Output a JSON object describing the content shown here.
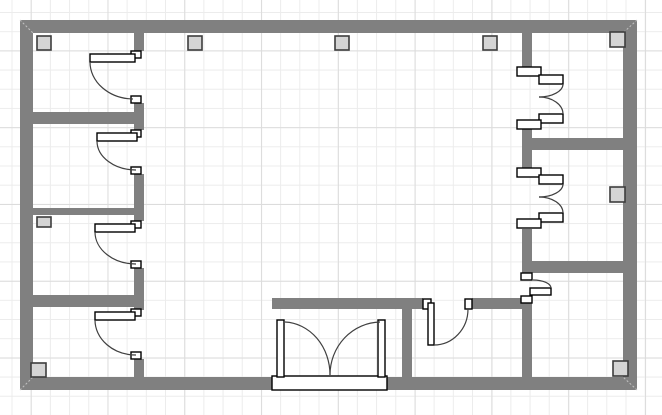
{
  "floorplan": {
    "canvas": {
      "width": 662,
      "height": 415,
      "bg": "#ffffff",
      "grid": {
        "minor": {
          "size": 19.2,
          "color": "#ececec",
          "offset_x": 11.5,
          "offset_y": 12
        },
        "major": {
          "size": 76.8,
          "color": "#dcdcdc",
          "offset_x": 30.7,
          "offset_y": 50.4
        }
      }
    },
    "style": {
      "wall_color": "#808080",
      "column_fill": "#d4d4d4",
      "column_stroke": "#3d3d3d",
      "column_stroke_width": 1.6,
      "door_fill": "#ffffff",
      "door_stroke": "#000000",
      "door_stroke_width": 1.4,
      "arc_color": "#404040",
      "arc_width": 1.2,
      "miter_color": "#c2c2c2"
    },
    "walls": [
      {
        "id": "outer-top",
        "x": 20,
        "y": 20,
        "w": 617,
        "h": 13
      },
      {
        "id": "outer-left",
        "x": 20,
        "y": 20,
        "w": 13,
        "h": 370
      },
      {
        "id": "outer-right",
        "x": 623,
        "y": 20,
        "w": 14,
        "h": 370
      },
      {
        "id": "outer-bottom-left",
        "x": 20,
        "y": 377,
        "w": 252,
        "h": 13
      },
      {
        "id": "outer-bottom-right",
        "x": 387,
        "y": 377,
        "w": 250,
        "h": 13
      },
      {
        "id": "left-core-a",
        "x": 134,
        "y": 33,
        "w": 10,
        "h": 18
      },
      {
        "id": "left-core-b",
        "x": 134,
        "y": 103,
        "w": 10,
        "h": 27
      },
      {
        "id": "left-core-c",
        "x": 134,
        "y": 174,
        "w": 10,
        "h": 47
      },
      {
        "id": "left-core-d",
        "x": 134,
        "y": 268,
        "w": 10,
        "h": 42
      },
      {
        "id": "left-core-e",
        "x": 134,
        "y": 359,
        "w": 10,
        "h": 18
      },
      {
        "id": "left-divider-1",
        "x": 33,
        "y": 112,
        "w": 111,
        "h": 12
      },
      {
        "id": "left-divider-2-thin",
        "x": 33,
        "y": 208,
        "w": 111,
        "h": 7
      },
      {
        "id": "left-divider-3",
        "x": 33,
        "y": 295,
        "w": 111,
        "h": 12
      },
      {
        "id": "right-core-a",
        "x": 522,
        "y": 33,
        "w": 10,
        "h": 34
      },
      {
        "id": "right-core-b",
        "x": 522,
        "y": 129,
        "w": 10,
        "h": 39
      },
      {
        "id": "right-core-c",
        "x": 522,
        "y": 229,
        "w": 10,
        "h": 44
      },
      {
        "id": "right-core-d",
        "x": 522,
        "y": 303,
        "w": 10,
        "h": 74
      },
      {
        "id": "right-divider-1",
        "x": 532,
        "y": 138,
        "w": 91,
        "h": 12
      },
      {
        "id": "right-divider-2",
        "x": 532,
        "y": 261,
        "w": 91,
        "h": 12
      },
      {
        "id": "bottom-partition-h1",
        "x": 272,
        "y": 298,
        "w": 151,
        "h": 11
      },
      {
        "id": "bottom-partition-h2",
        "x": 472,
        "y": 298,
        "w": 50,
        "h": 11
      },
      {
        "id": "bottom-partition-v",
        "x": 402,
        "y": 309,
        "w": 10,
        "h": 68
      }
    ],
    "columns": [
      {
        "x": 37,
        "y": 36,
        "w": 14,
        "h": 14
      },
      {
        "x": 188,
        "y": 36,
        "w": 14,
        "h": 14
      },
      {
        "x": 335,
        "y": 36,
        "w": 14,
        "h": 14
      },
      {
        "x": 483,
        "y": 36,
        "w": 14,
        "h": 14
      },
      {
        "x": 610,
        "y": 32,
        "w": 15,
        "h": 15
      },
      {
        "x": 37,
        "y": 217,
        "w": 14,
        "h": 10
      },
      {
        "x": 31,
        "y": 363,
        "w": 15,
        "h": 14
      },
      {
        "x": 610,
        "y": 187,
        "w": 15,
        "h": 15
      },
      {
        "x": 613,
        "y": 361,
        "w": 15,
        "h": 15
      }
    ],
    "doors": [
      {
        "id": "door-room-1",
        "rects": [
          [
            131,
            51,
            10,
            7
          ],
          [
            131,
            96,
            10,
            7
          ],
          [
            90,
            54,
            45,
            8
          ]
        ],
        "arcs": [
          "M 90 62 A 44 37 0 0 0 133 99"
        ]
      },
      {
        "id": "door-room-2",
        "rects": [
          [
            131,
            130,
            10,
            7
          ],
          [
            131,
            167,
            10,
            7
          ],
          [
            97,
            133,
            40,
            8
          ]
        ],
        "arcs": [
          "M 97 141 A 39 29 0 0 0 136 170"
        ]
      },
      {
        "id": "door-room-3",
        "rects": [
          [
            131,
            221,
            10,
            7
          ],
          [
            131,
            261,
            10,
            7
          ],
          [
            95,
            224,
            40,
            8
          ]
        ],
        "arcs": [
          "M 95 232 A 41 32 0 0 0 136 264"
        ]
      },
      {
        "id": "door-room-4",
        "rects": [
          [
            131,
            309,
            10,
            7
          ],
          [
            131,
            352,
            10,
            7
          ],
          [
            95,
            312,
            40,
            8
          ]
        ],
        "arcs": [
          "M 95 320 A 41 35 0 0 0 136 355"
        ]
      },
      {
        "id": "double-door-upper-right",
        "rects": [
          [
            517,
            67,
            24,
            9
          ],
          [
            539,
            75,
            24,
            9
          ],
          [
            539,
            114,
            24,
            9
          ],
          [
            517,
            120,
            24,
            9
          ]
        ],
        "arcs": [
          "M 563 84 A 24 13 0 0 1 539 97",
          "M 539 97 A 24 17 0 0 1 563 114"
        ]
      },
      {
        "id": "double-door-mid-right",
        "rects": [
          [
            517,
            168,
            24,
            9
          ],
          [
            539,
            175,
            24,
            9
          ],
          [
            539,
            213,
            24,
            9
          ],
          [
            517,
            219,
            24,
            9
          ]
        ],
        "arcs": [
          "M 563 184 A 24 13 0 0 1 539 197",
          "M 539 197 A 24 16 0 0 1 563 213"
        ]
      },
      {
        "id": "door-lower-right",
        "rects": [
          [
            521,
            273,
            11,
            7
          ],
          [
            521,
            296,
            11,
            7
          ],
          [
            530,
            288,
            21,
            7
          ]
        ],
        "arcs": [
          "M 533 280 A 18 8 0 0 1 551 288"
        ]
      },
      {
        "id": "door-bottom-partition",
        "rects": [
          [
            423,
            299,
            8,
            10
          ],
          [
            465,
            299,
            7,
            10
          ],
          [
            428,
            303,
            6,
            42
          ]
        ],
        "arcs": [
          "M 434 345 A 34 36 0 0 0 468 309"
        ]
      },
      {
        "id": "double-entry-door",
        "rects": [
          [
            272,
            376,
            115,
            14
          ],
          [
            277,
            320,
            7,
            57
          ],
          [
            378,
            320,
            7,
            57
          ]
        ],
        "arcs": [
          "M 285 322 A 47 53 0 0 1 330 375",
          "M 380 322 A 51 53 0 0 0 330 375"
        ]
      }
    ],
    "miters": [
      [
        20,
        20,
        33,
        33
      ],
      [
        637,
        20,
        623,
        33
      ],
      [
        20,
        390,
        33,
        377
      ],
      [
        637,
        390,
        623,
        377
      ]
    ]
  }
}
